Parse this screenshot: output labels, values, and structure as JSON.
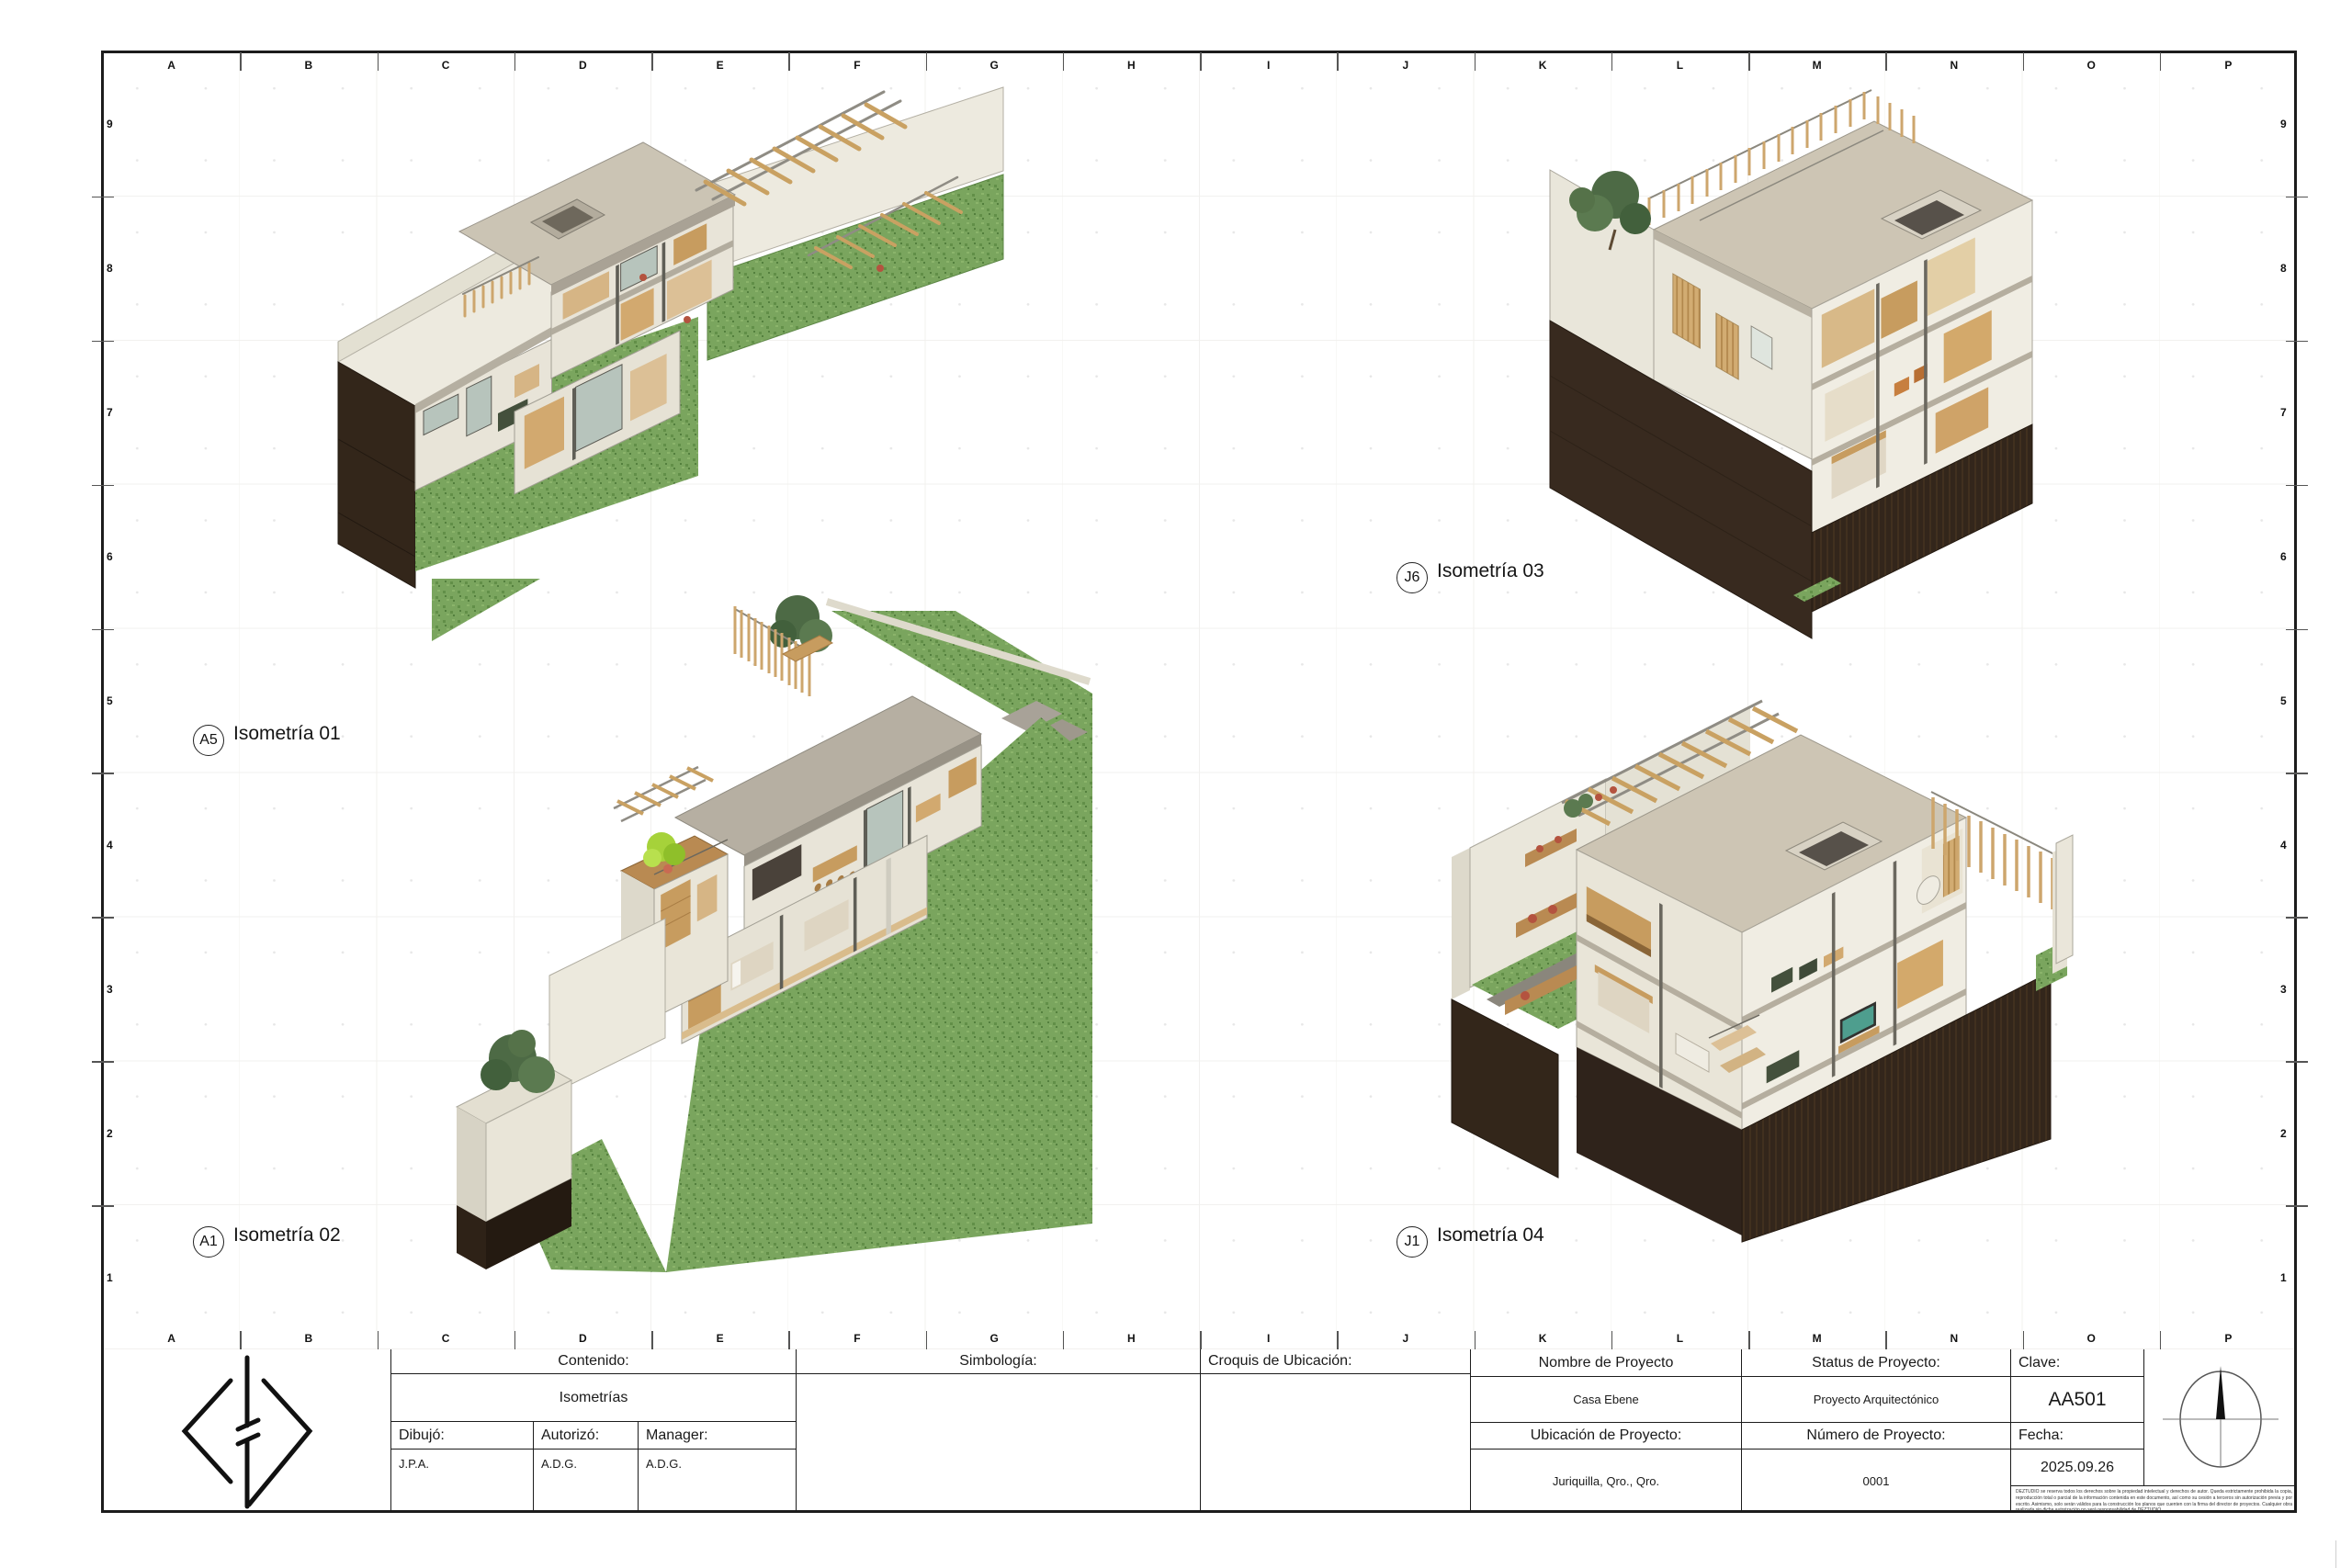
{
  "sheet": {
    "grid": {
      "columns": [
        "A",
        "B",
        "C",
        "D",
        "E",
        "F",
        "G",
        "H",
        "I",
        "J",
        "K",
        "L",
        "M",
        "N",
        "O",
        "P"
      ],
      "rows": [
        "9",
        "8",
        "7",
        "6",
        "5",
        "4",
        "3",
        "2",
        "1"
      ]
    },
    "views": [
      {
        "tag": "A5",
        "title": "Isometría 01"
      },
      {
        "tag": "A1",
        "title": "Isometría 02"
      },
      {
        "tag": "J6",
        "title": "Isometría 03"
      },
      {
        "tag": "J1",
        "title": "Isometría 04"
      }
    ],
    "title_block": {
      "contenido_label": "Contenido:",
      "contenido_value": "Isometrías",
      "dibujo_label": "Dibujó:",
      "dibujo_value": "J.P.A.",
      "autorizo_label": "Autorizó:",
      "autorizo_value": "A.D.G.",
      "manager_label": "Manager:",
      "manager_value": "A.D.G.",
      "simbologia_label": "Simbología:",
      "croquis_label": "Croquis de Ubicación:",
      "nombre_label": "Nombre de Proyecto",
      "nombre_value": "Casa Ebene",
      "ubicacion_label": "Ubicación de Proyecto:",
      "ubicacion_value": "Juriquilla, Qro., Qro.",
      "status_label": "Status de Proyecto:",
      "status_value": "Proyecto Arquitectónico",
      "numero_label": "Número de Proyecto:",
      "numero_value": "0001",
      "clave_label": "Clave:",
      "clave_value": "AA501",
      "fecha_label": "Fecha:",
      "fecha_value": "2025.09.26",
      "disclaimer": "DEZTUDIO se reserva todos los derechos sobre la propiedad intelectual y derechos de autor. Queda estrictamente prohibida la copia, reproducción total o parcial de la información contenida en este documento, así como su cesión a terceros sin autorización previa y por escrito. Asimismo, solo serán válidos para la construcción los planos que cuenten con la firma del director de proyectos. Cualquier obra realizada sin dicha autorización no será responsabilidad de DEZTUDIO."
    },
    "colors": {
      "grass": "#7aa55e",
      "earth_dark": "#33261a",
      "wall_cream": "#e9e6db",
      "roof_beige": "#cdc5b4",
      "wood": "#c79c5f",
      "accent_plant": "#a6d23a"
    }
  }
}
